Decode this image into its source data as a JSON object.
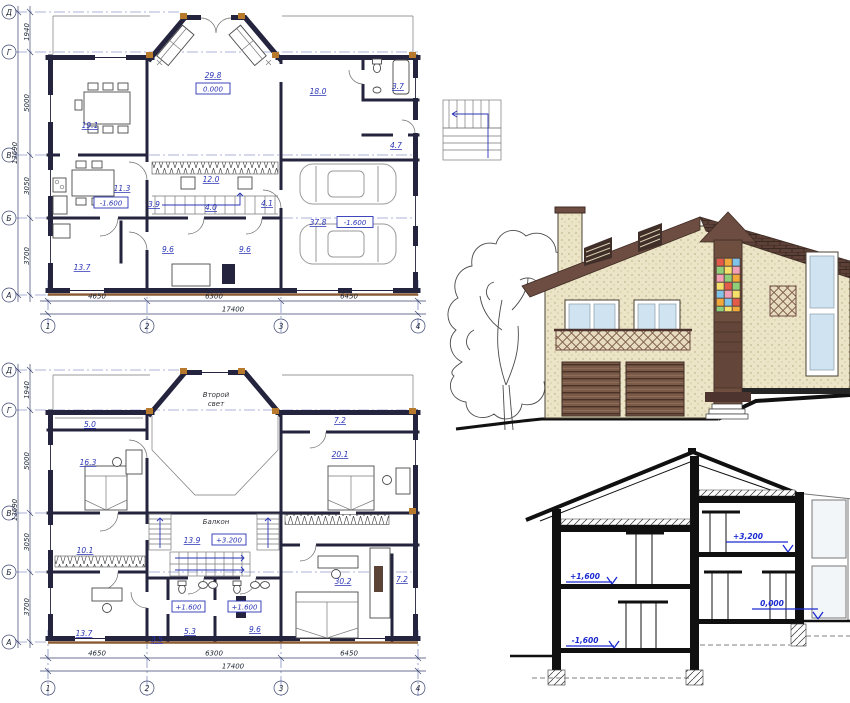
{
  "p1": {
    "dining": "19.1",
    "living": "29.8",
    "living_lvl": "0.000",
    "room18": "18.0",
    "wc": "3.7",
    "hall47": "4.7",
    "kitchen": "11.3",
    "kitchen_lvl": "-1.600",
    "h39": "3.9",
    "st12": "12.0",
    "h40": "4.0",
    "h41": "4.1",
    "r96a": "9.6",
    "r96b": "9.6",
    "r137": "13.7",
    "garage": "37.8",
    "garage_lvl": "-1.600"
  },
  "p2": {
    "light1": "Второй",
    "light2": "свет",
    "balcony": "Балкон",
    "r50": "5.0",
    "r163": "16.3",
    "r72a": "7.2",
    "r201": "20.1",
    "r139": "13.9",
    "lvl32": "+3.200",
    "r101": "10.1",
    "r137": "13.7",
    "r35": "3.5",
    "lvl16a": "+1.600",
    "lvl16b": "+1.600",
    "r53": "5.3",
    "r96": "9.6",
    "r302": "30.2",
    "r72b": "7.2"
  },
  "grid": {
    "c1": "4650",
    "c2": "6300",
    "c3": "6450",
    "ctot": "17400",
    "r1": "1940",
    "r2": "5000",
    "r3": "3050",
    "r4": "3700",
    "rtot": "13690",
    "n1": "1",
    "n2": "2",
    "n3": "3",
    "n4": "4",
    "ad": "Д",
    "ag": "Г",
    "av": "В",
    "ab": "Б",
    "aa": "А"
  },
  "sect": {
    "l16": "+1,600",
    "lm16": "-1,600",
    "l32": "+3,200",
    "l0": "0,000"
  },
  "colors": {
    "wall_dark": "#24243e",
    "annotation_blue": "#2a34b5",
    "level_blue": "#1b2bd0",
    "wall_beige": "#ece4c6",
    "roof_brown": "#6d4c41",
    "tile_brown": "#5d4037",
    "door_brown": "#7a5a48",
    "glass_blue": "#cfe3f0",
    "corner_accent": "#b7792c",
    "stained_glass": [
      "#e25b4a",
      "#f2a93b",
      "#f5e06a",
      "#8fcf7a",
      "#f2a0b5",
      "#7fc4e8"
    ]
  }
}
